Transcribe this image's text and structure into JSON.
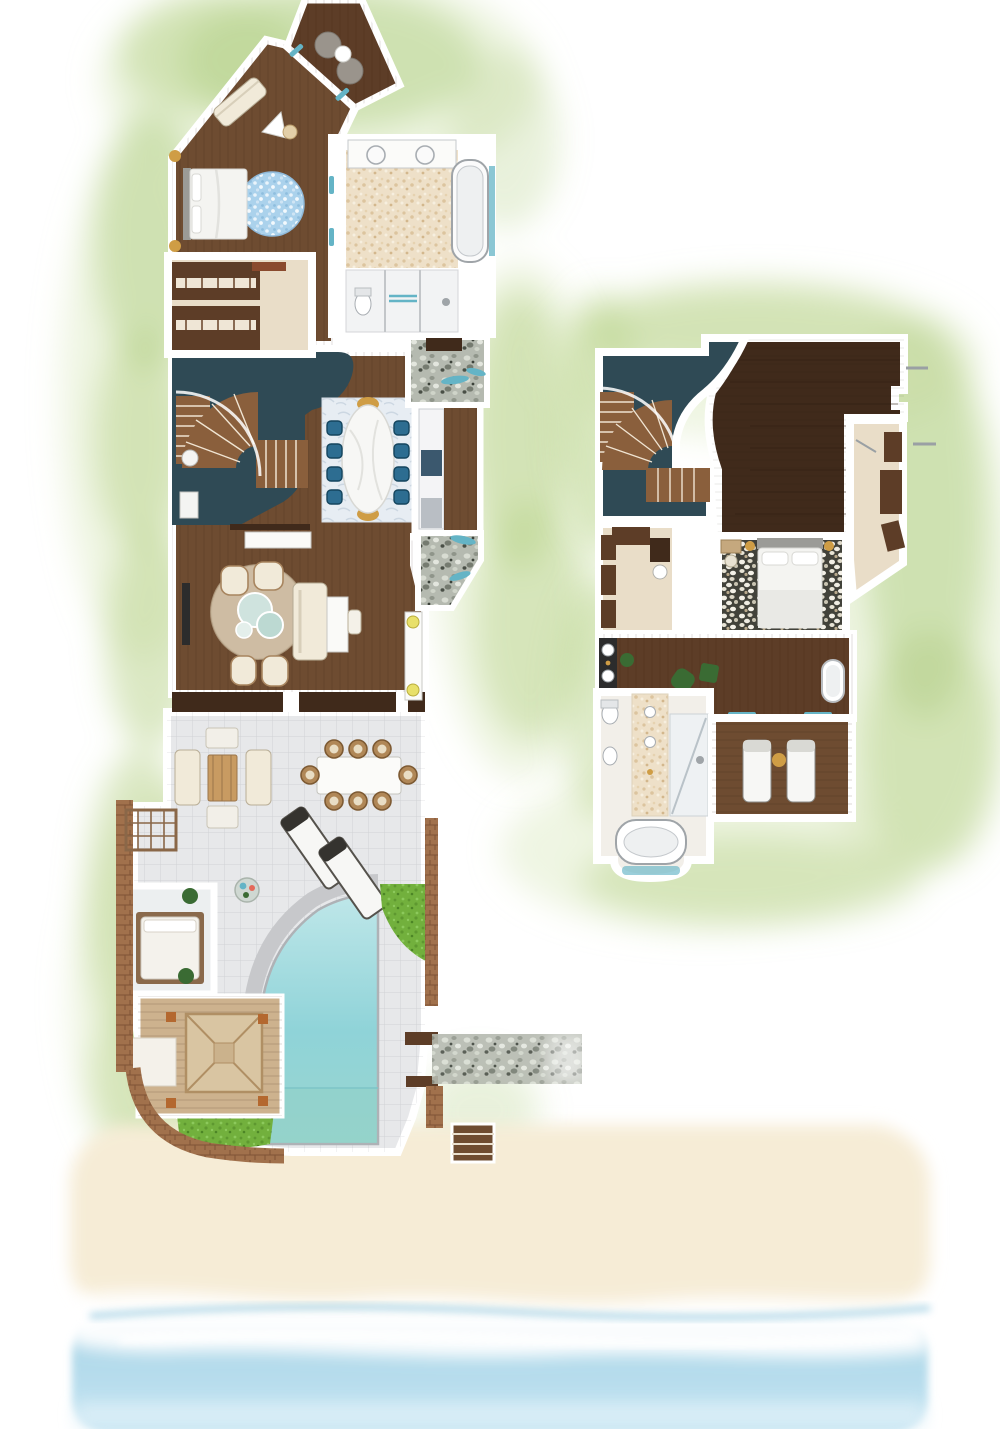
{
  "image_type": "resort-villa-floor-plan-illustration",
  "floors": [
    {
      "id": "ground-floor",
      "features": [
        "terrace-sala",
        "master-bedroom",
        "walk-in-closet",
        "master-bathroom",
        "void-over-stair",
        "curved-staircase",
        "dining-room",
        "kitchen",
        "pebble-entry-path",
        "living-room",
        "pool-deck",
        "outdoor-lounge",
        "outdoor-dining",
        "sun-loungers",
        "daybed-court",
        "beach-pavilion",
        "plunge-pool",
        "garden-patches",
        "beach-steps"
      ]
    },
    {
      "id": "upper-floor",
      "features": [
        "curved-staircase",
        "void-over-stair",
        "loft-lounge",
        "walk-in-wardrobe",
        "angled-dressing-room",
        "bedroom-pebble-floor",
        "hallway-vanity",
        "freestanding-tub",
        "bathroom",
        "balcony-loungers"
      ]
    }
  ],
  "environment": [
    "watercolor-greenery",
    "sand-beach",
    "surf-foam",
    "ocean"
  ],
  "palette": {
    "halo1": "#b7d28a",
    "halo2": "#d6e7ba",
    "voidTeal": "#2f4a55",
    "woodDark": "#402a1b",
    "woodMid": "#6e4c31",
    "woodMed": "#5d3d27",
    "woodStair": "#8a5f3c",
    "deckTan": "#cdb28e",
    "roofTan": "#d9c5a2",
    "carpet": "#e9ddc8",
    "bathBeige": "#eee0c8",
    "wall": "#ffffff",
    "tileGray": "#e7e8ea",
    "poolLight": "#bfe7e9",
    "poolMid": "#8fd3d8",
    "doorTeal": "#64b4c6",
    "chairTeal": "#2d6d91",
    "rugBlue": "#abd2ec",
    "rugBeige": "#d8c9b0",
    "cream": "#f1ead9",
    "sandTone": "#f6ecd6",
    "seaTone": "#b7dcec",
    "grassGreen": "#72b03d",
    "pebbleBase": "#b5bab0",
    "brickTone": "#a1714c",
    "goldTone": "#cf9d45",
    "plantGreen": "#3a6b33",
    "stoneGray": "#c7c8cb",
    "charcoal": "#2c2c2c"
  }
}
